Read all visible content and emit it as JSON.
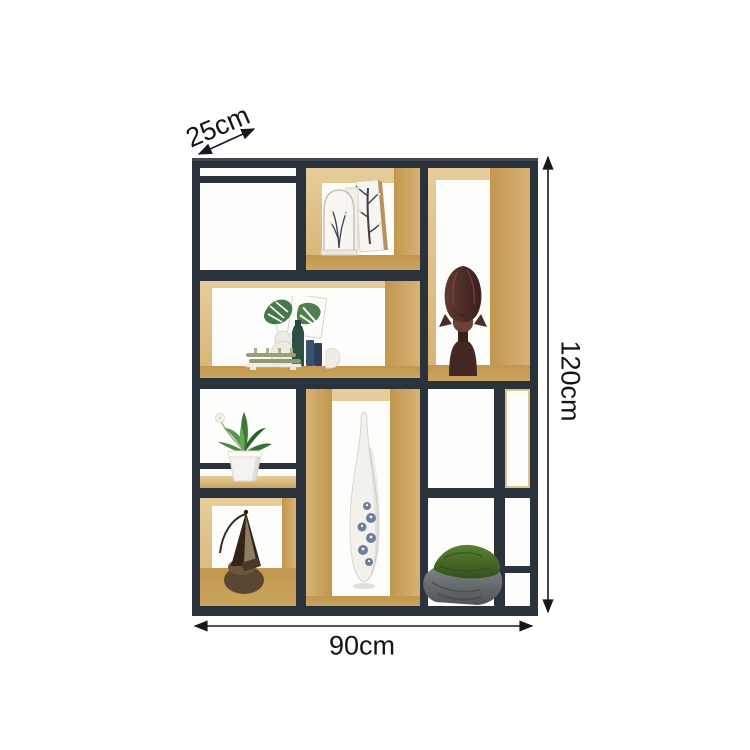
{
  "dimensions": {
    "depth": "25cm",
    "height": "120cm",
    "width": "90cm"
  },
  "colors": {
    "frame": "#2a323c",
    "frame_light": "#3e4752",
    "wood_light": "#e6cd99",
    "wood_mid": "#d6b274",
    "wood_dark": "#c2974f",
    "wood_floor": "#c9a55e",
    "background": "#ffffff",
    "line": "#15181c",
    "text": "#141414"
  },
  "decor": {
    "cloche": "glass cloche with dried plant and branch print cards",
    "bust": "carved wooden bust",
    "vignette": "monstera leaves with vases and bamboo raft",
    "plant": "potted green plant",
    "floor_vase": "tall white vase with blue floral pattern",
    "sculpture": "abstract bronze sculpture",
    "moss_rock": "moss covered stone"
  }
}
